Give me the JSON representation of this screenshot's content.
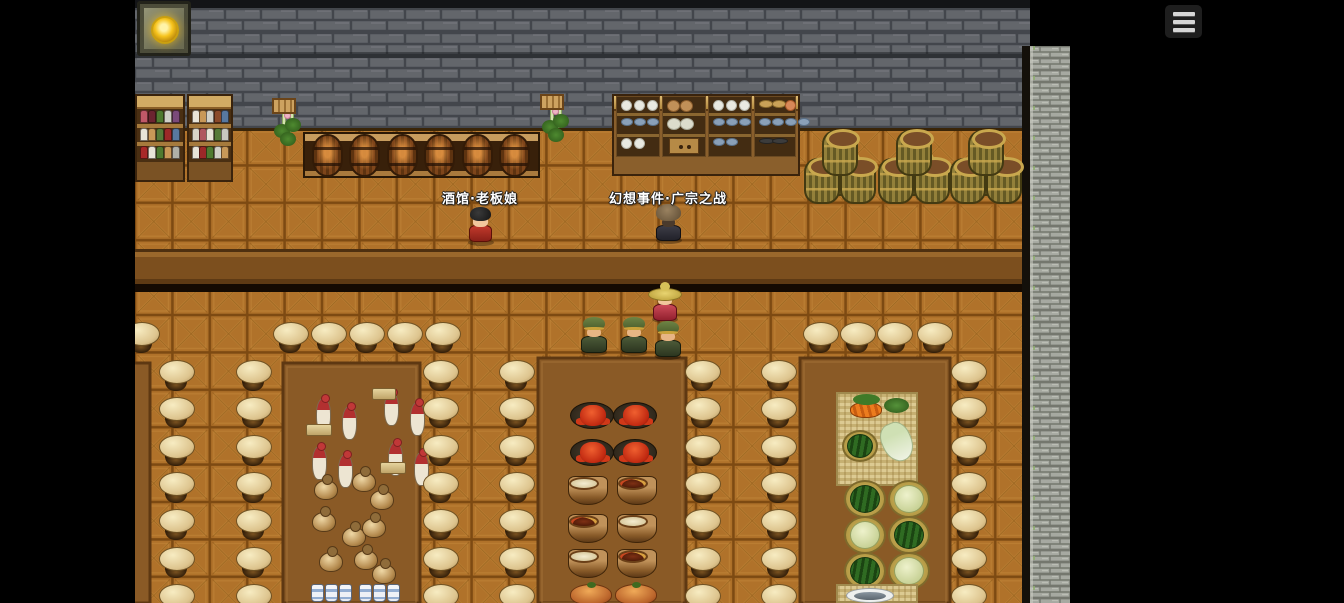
{
  "app": {
    "type": "rpg-tavern-scene"
  },
  "hud": {
    "menu_button": {
      "icon": "hamburger-menu-icon",
      "bars": 3
    },
    "wall_lantern": {
      "icon": "lantern-icon"
    }
  },
  "labels": {
    "innkeeper": "酒馆·老板娘",
    "event": "幻想事件·广宗之战"
  },
  "palette": {
    "letterbox": "#000000",
    "wall_dark": "#63666b",
    "wall_mortar": "#43464c",
    "wall_light": "#a6a9a1",
    "floor_base": "#b0722a",
    "floor_line": "#7d4a12",
    "counter_band": "#7c4f1e",
    "platform": "#8a5a26",
    "stool_top": "#e8d5a4",
    "label_text": "#ffffff"
  },
  "npcs": [
    {
      "name": "npc-innkeeper",
      "type": "boss",
      "x": 464,
      "y": 205
    },
    {
      "name": "npc-event-hooded",
      "type": "hooded",
      "x": 652,
      "y": 203
    },
    {
      "name": "npc-straw-hat",
      "type": "strawhat",
      "x": 648,
      "y": 282
    },
    {
      "name": "npc-soldier",
      "type": "soldier",
      "x": 577,
      "y": 315
    },
    {
      "name": "npc-soldier",
      "type": "soldier",
      "x": 617,
      "y": 315
    },
    {
      "name": "npc-soldier",
      "type": "soldier",
      "x": 651,
      "y": 319
    }
  ],
  "scene": {
    "stool_row": {
      "y": 337,
      "xs": [
        141,
        290,
        328,
        366,
        404,
        442,
        820,
        857,
        894,
        934
      ]
    },
    "stool_cols": {
      "xs": [
        176,
        253,
        440,
        516,
        702,
        778,
        968
      ],
      "ys": [
        375,
        412,
        450,
        487,
        524,
        562,
        599
      ]
    },
    "counter_stand": {
      "x": 303,
      "y": 132
    },
    "counter_barrels": [
      327,
      364,
      402,
      439,
      477,
      514
    ],
    "barrel_stacks": [
      840,
      914,
      986
    ],
    "plants": [
      {
        "x": 272,
        "y": 98
      },
      {
        "x": 540,
        "y": 94
      }
    ],
    "shelf_units": [
      {
        "x": 135,
        "y": 94,
        "w": 50,
        "rows": [
          [
            "#c05868",
            "#6b2430",
            "#4e7a30",
            "#d0d0c8",
            "#7a4a7a"
          ],
          [
            "#e8e4d8",
            "#c89858",
            "#567a38",
            "#9c2828",
            "#5878a0"
          ],
          [
            "#a82828",
            "#e8e4d8",
            "#4e7a30",
            "#c89858",
            "#b0b0a8"
          ]
        ]
      },
      {
        "x": 187,
        "y": 94,
        "w": 46,
        "rows": [
          [
            "#e8e4d8",
            "#c89858",
            "#d0d0c8",
            "#8a4a2a",
            "#5878a0"
          ],
          [
            "#d8d4c8",
            "#b05860",
            "#e8e4d8",
            "#567a38",
            "#c8c8c0"
          ],
          [
            "#e8e4d8",
            "#9c2828",
            "#4e7a30",
            "#d0d0c8",
            "#c89858"
          ]
        ]
      }
    ],
    "cupboard": {
      "x": 612,
      "y": 94,
      "sections": [
        {
          "rows": [
            [
              "plate",
              "plate",
              "plate"
            ],
            [
              "bowl",
              "bowl",
              "bowl"
            ],
            [
              "plate",
              "plate"
            ]
          ]
        },
        {
          "rows": [
            [
              "pot",
              "pot"
            ],
            [
              "egg",
              "egg"
            ],
            [
              "drawer"
            ]
          ]
        },
        {
          "rows": [
            [
              "plate",
              "plate",
              "plate"
            ],
            [
              "bowl",
              "bowl",
              "bowl"
            ],
            [
              "bowl",
              "bowl"
            ]
          ]
        },
        {
          "rows": [
            [
              "bread",
              "bread",
              "peach"
            ],
            [
              "bowl",
              "bowl",
              "bowl",
              "bowl"
            ],
            [
              "tray",
              "tray"
            ]
          ]
        }
      ]
    },
    "bottles": [
      [
        316,
        398
      ],
      [
        342,
        406
      ],
      [
        384,
        392
      ],
      [
        410,
        402
      ],
      [
        312,
        446
      ],
      [
        338,
        454
      ],
      [
        388,
        442
      ],
      [
        414,
        452
      ]
    ],
    "trays": [
      [
        306,
        424,
        26
      ],
      [
        372,
        388,
        24
      ],
      [
        380,
        462,
        26
      ]
    ],
    "jugs": [
      [
        314,
        480
      ],
      [
        352,
        472
      ],
      [
        370,
        490
      ],
      [
        312,
        512
      ],
      [
        342,
        527
      ],
      [
        362,
        518
      ],
      [
        319,
        552
      ],
      [
        354,
        550
      ],
      [
        372,
        564
      ]
    ],
    "steins": {
      "y": 584,
      "xs": [
        311,
        325,
        339,
        359,
        373,
        387
      ]
    },
    "crab_plates": [
      [
        570,
        402
      ],
      [
        613,
        402
      ],
      [
        570,
        439
      ],
      [
        613,
        439
      ]
    ],
    "pots": [
      {
        "x": 568,
        "y": 476,
        "t": "soup"
      },
      {
        "x": 617,
        "y": 476,
        "t": "stew"
      },
      {
        "x": 568,
        "y": 514,
        "t": "stew"
      },
      {
        "x": 617,
        "y": 514,
        "t": "soup"
      },
      {
        "x": 568,
        "y": 549,
        "t": "soup"
      },
      {
        "x": 617,
        "y": 549,
        "t": "stew"
      }
    ],
    "roasts": [
      [
        570,
        584
      ],
      [
        615,
        584
      ]
    ],
    "produce_mat": {
      "x": 836,
      "y": 392,
      "w": 82,
      "h": 94
    },
    "baskets": [
      {
        "x": 844,
        "y": 480,
        "t": "wm"
      },
      {
        "x": 888,
        "y": 480,
        "t": "pale"
      },
      {
        "x": 844,
        "y": 516,
        "t": "pale"
      },
      {
        "x": 888,
        "y": 516,
        "t": "wm"
      },
      {
        "x": 844,
        "y": 552,
        "t": "wm"
      },
      {
        "x": 888,
        "y": 552,
        "t": "pale"
      }
    ],
    "fish_mat": {
      "x": 836,
      "y": 584,
      "w": 82,
      "h": 19
    }
  }
}
